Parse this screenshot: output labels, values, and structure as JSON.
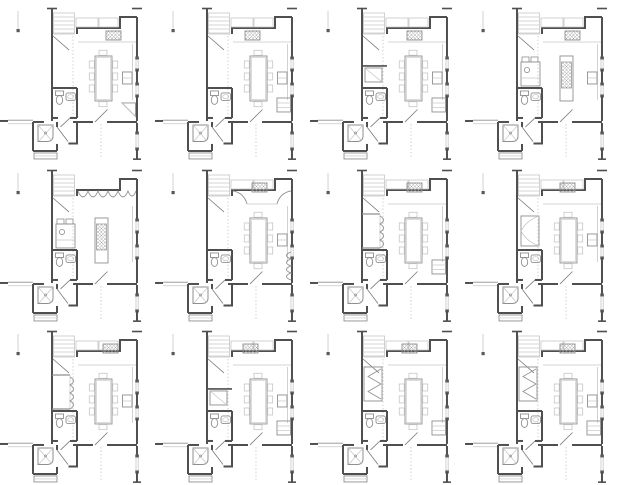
{
  "document": {
    "kind": "architectural-floor-plan-options-sheet",
    "background": "#ffffff"
  },
  "palette": {
    "wall": "#4f4f4f",
    "door_leaf": "#7a7a7a",
    "medium": "#8f8f8f",
    "light": "#c6c6c6",
    "hatch_line": "#9f9f9f",
    "marker": "#5a5a5a",
    "background": "#ffffff"
  },
  "grid": {
    "rows": 3,
    "cols": 4,
    "tile_width": 155,
    "tile_height": 161.666
  },
  "common_elements": [
    "stair-run-top-left",
    "reference-line-with-square-marker",
    "hall-dashed-projection-line",
    "kitchen-north-wall-with-jog",
    "upper-cabinet-outlines",
    "right-wall-with-two-windows",
    "lower-right-wall-window",
    "bathroom-toilet-and-sink",
    "bathroom-door-swing",
    "entry-door-swing",
    "vestibule-door-swing",
    "shower-room-with-x-pan",
    "exterior-stub-wall-left",
    "step-block-below-shower"
  ],
  "plans": [
    {
      "id": "plan-01",
      "row": 1,
      "col": 1,
      "center_feature": "dining-table",
      "cooktop": {
        "x": 106,
        "y": 31
      },
      "top_feature": "cabinets",
      "left_feature": "none",
      "right_bottom_feature": "corner-diagonal",
      "mid_right_appliance": true
    },
    {
      "id": "plan-02",
      "row": 1,
      "col": 2,
      "center_feature": "dining-table",
      "cooktop": {
        "x": 90,
        "y": 31
      },
      "top_feature": "cabinets",
      "left_feature": "none",
      "right_bottom_feature": "gray-block",
      "mid_right_appliance": true
    },
    {
      "id": "plan-03",
      "row": 1,
      "col": 3,
      "center_feature": "dining-table",
      "cooktop": {
        "x": 97,
        "y": 31
      },
      "top_feature": "cabinets",
      "left_feature": "closet-gray",
      "right_bottom_feature": "gray-block",
      "mid_right_appliance": true
    },
    {
      "id": "plan-04",
      "row": 1,
      "col": 4,
      "center_feature": "island",
      "cooktop": {
        "x": 100,
        "y": 31
      },
      "top_feature": "cabinets",
      "left_feature": "counter-block",
      "right_bottom_feature": "none",
      "mid_right_appliance": true
    },
    {
      "id": "plan-05",
      "row": 2,
      "col": 1,
      "center_feature": "island",
      "cooktop": null,
      "top_feature": "scallop-band",
      "left_feature": "counter-block",
      "right_bottom_feature": "none",
      "mid_right_appliance": false
    },
    {
      "id": "plan-06",
      "row": 2,
      "col": 2,
      "center_feature": "dining-table",
      "cooktop": {
        "x": 97,
        "y": 21
      },
      "top_feature": "corner-scallops",
      "left_feature": "none",
      "right_bottom_feature": "scallops",
      "mid_right_appliance": true
    },
    {
      "id": "plan-07",
      "row": 2,
      "col": 3,
      "center_feature": "dining-table",
      "cooktop": {
        "x": 97,
        "y": 21
      },
      "top_feature": "cabinets",
      "left_feature": "pantry-scallops",
      "right_bottom_feature": "gray-block",
      "mid_right_appliance": false
    },
    {
      "id": "plan-08",
      "row": 2,
      "col": 4,
      "center_feature": "dining-table",
      "cooktop": {
        "x": 95,
        "y": 21
      },
      "top_feature": "cabinets",
      "left_feature": "cabinet-arcs",
      "right_bottom_feature": "none",
      "mid_right_appliance": true
    },
    {
      "id": "plan-09",
      "row": 3,
      "col": 1,
      "center_feature": "dining-table",
      "cooktop": {
        "x": 103,
        "y": 21
      },
      "top_feature": "cabinets",
      "left_feature": "pantry-scallops",
      "right_bottom_feature": "none",
      "mid_right_appliance": true
    },
    {
      "id": "plan-10",
      "row": 3,
      "col": 2,
      "center_feature": "dining-table",
      "cooktop": {
        "x": 88,
        "y": 21
      },
      "top_feature": "cabinets",
      "left_feature": "closet-gray",
      "right_bottom_feature": "gray-block",
      "mid_right_appliance": true
    },
    {
      "id": "plan-11",
      "row": 3,
      "col": 3,
      "center_feature": "dining-table",
      "cooktop": {
        "x": 92,
        "y": 21
      },
      "top_feature": "cabinets",
      "left_feature": "triangle-closet",
      "right_bottom_feature": "gray-block",
      "mid_right_appliance": false
    },
    {
      "id": "plan-12",
      "row": 3,
      "col": 4,
      "center_feature": "dining-table",
      "cooktop": {
        "x": 95,
        "y": 21
      },
      "top_feature": "cabinets",
      "left_feature": "triangle-closet",
      "right_bottom_feature": "gray-block",
      "mid_right_appliance": true
    }
  ]
}
